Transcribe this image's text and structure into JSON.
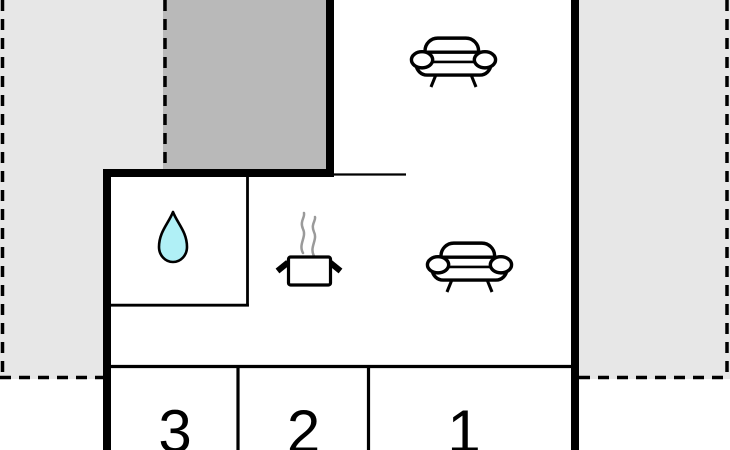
{
  "plan": {
    "title": "holiday-home floor plan",
    "colors": {
      "background": "#ffffff",
      "terrace_fill": "#e7e7e7",
      "annex_fill": "#b9b9b9",
      "wall": "#000000",
      "drop_fill": "#b0f0f6",
      "steam": "#9a9a9a",
      "label_color": "#000000"
    },
    "rooms": [
      {
        "label": "3"
      },
      {
        "label": "2"
      },
      {
        "label": "1"
      }
    ],
    "icons": {
      "sofa_top": "sofa-icon",
      "sofa_middle": "sofa-icon",
      "water_drop": "water-drop-icon",
      "cooking_pot": "cooking-pot-icon"
    }
  }
}
